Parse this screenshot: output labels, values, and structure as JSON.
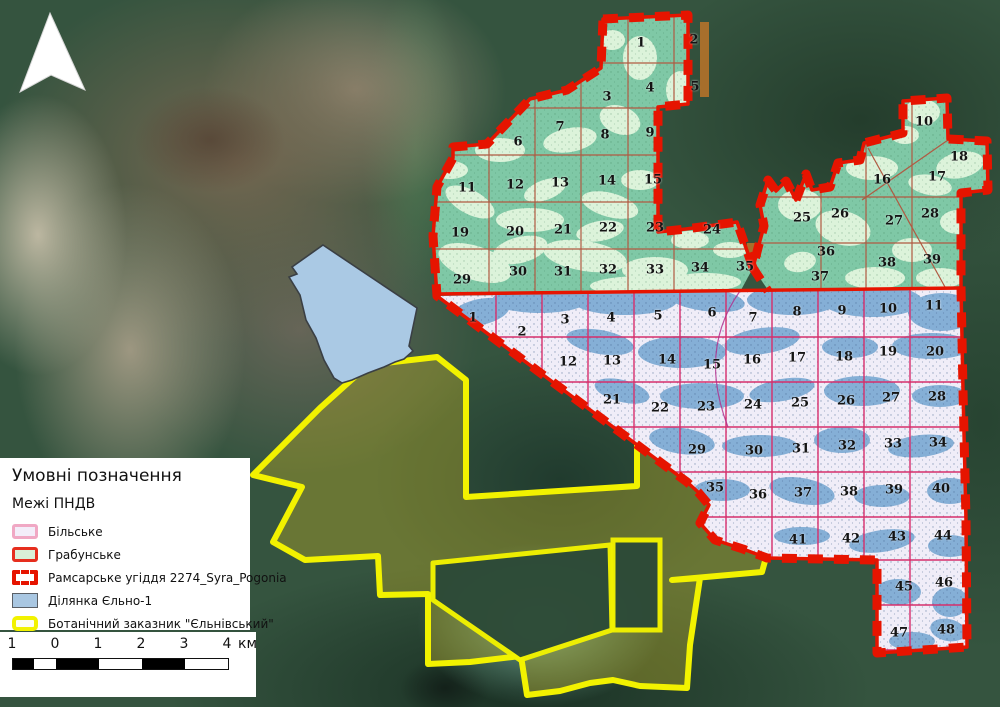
{
  "legend": {
    "title": "Умовні позначення",
    "subtitle": "Межі ПНДВ",
    "items": [
      {
        "type": "bilske",
        "label": "Більське"
      },
      {
        "type": "hrabunske",
        "label": "Грабунське"
      },
      {
        "type": "ramsar",
        "label": "Рамсарське угіддя 2274_Syra_Pogonia"
      },
      {
        "type": "yelno",
        "label": "Ділянка Єльно-1"
      },
      {
        "type": "botanical",
        "label": "Ботанічний заказник \"Єльнівський\""
      }
    ]
  },
  "scalebar": {
    "labels": [
      "1",
      "0",
      "1",
      "2",
      "3",
      "4"
    ],
    "unit": "км"
  },
  "colors": {
    "ramsar_red": "#e61400",
    "grid_green_region": "#b05a42",
    "grid_blue_region": "#d62e6b",
    "hrabunske_base": "#7fc8a6",
    "hrabunske_patch": "#dcf3da",
    "bilske_base": "#f0edf8",
    "yelno_blue": "#85afd6",
    "yelno_polygon_fill": "#aac9e4",
    "botanical_yellow": "#f2f200",
    "north_arrow": "#ffffff"
  },
  "regions": {
    "hrabunske": {
      "name": "Грабунське",
      "compartments": [
        {
          "n": "1",
          "x": 641,
          "y": 43
        },
        {
          "n": "2",
          "x": 694,
          "y": 40
        },
        {
          "n": "3",
          "x": 607,
          "y": 97
        },
        {
          "n": "4",
          "x": 650,
          "y": 88
        },
        {
          "n": "5",
          "x": 695,
          "y": 87
        },
        {
          "n": "6",
          "x": 518,
          "y": 142
        },
        {
          "n": "7",
          "x": 560,
          "y": 127
        },
        {
          "n": "8",
          "x": 605,
          "y": 135
        },
        {
          "n": "9",
          "x": 650,
          "y": 133
        },
        {
          "n": "10",
          "x": 924,
          "y": 122
        },
        {
          "n": "11",
          "x": 467,
          "y": 188
        },
        {
          "n": "12",
          "x": 515,
          "y": 185
        },
        {
          "n": "13",
          "x": 560,
          "y": 183
        },
        {
          "n": "14",
          "x": 607,
          "y": 181
        },
        {
          "n": "15",
          "x": 653,
          "y": 180
        },
        {
          "n": "16",
          "x": 882,
          "y": 180
        },
        {
          "n": "17",
          "x": 937,
          "y": 177
        },
        {
          "n": "18",
          "x": 959,
          "y": 157
        },
        {
          "n": "19",
          "x": 460,
          "y": 233
        },
        {
          "n": "20",
          "x": 515,
          "y": 232
        },
        {
          "n": "21",
          "x": 563,
          "y": 230
        },
        {
          "n": "22",
          "x": 608,
          "y": 228
        },
        {
          "n": "23",
          "x": 655,
          "y": 228
        },
        {
          "n": "24",
          "x": 712,
          "y": 230
        },
        {
          "n": "25",
          "x": 802,
          "y": 218
        },
        {
          "n": "26",
          "x": 840,
          "y": 214
        },
        {
          "n": "27",
          "x": 894,
          "y": 221
        },
        {
          "n": "28",
          "x": 930,
          "y": 214
        },
        {
          "n": "29",
          "x": 462,
          "y": 280
        },
        {
          "n": "30",
          "x": 518,
          "y": 272
        },
        {
          "n": "31",
          "x": 563,
          "y": 272
        },
        {
          "n": "32",
          "x": 608,
          "y": 270
        },
        {
          "n": "33",
          "x": 655,
          "y": 270
        },
        {
          "n": "34",
          "x": 700,
          "y": 268
        },
        {
          "n": "35",
          "x": 745,
          "y": 267
        },
        {
          "n": "36",
          "x": 826,
          "y": 252
        },
        {
          "n": "37",
          "x": 820,
          "y": 277
        },
        {
          "n": "38",
          "x": 887,
          "y": 263
        },
        {
          "n": "39",
          "x": 932,
          "y": 260
        }
      ]
    },
    "bilske": {
      "name": "Більське",
      "compartments": [
        {
          "n": "1",
          "x": 473,
          "y": 318
        },
        {
          "n": "2",
          "x": 522,
          "y": 332
        },
        {
          "n": "3",
          "x": 565,
          "y": 320
        },
        {
          "n": "4",
          "x": 611,
          "y": 318
        },
        {
          "n": "5",
          "x": 658,
          "y": 316
        },
        {
          "n": "6",
          "x": 712,
          "y": 313
        },
        {
          "n": "7",
          "x": 753,
          "y": 318
        },
        {
          "n": "8",
          "x": 797,
          "y": 312
        },
        {
          "n": "9",
          "x": 842,
          "y": 311
        },
        {
          "n": "10",
          "x": 888,
          "y": 309
        },
        {
          "n": "11",
          "x": 934,
          "y": 306
        },
        {
          "n": "12",
          "x": 568,
          "y": 362
        },
        {
          "n": "13",
          "x": 612,
          "y": 361
        },
        {
          "n": "14",
          "x": 667,
          "y": 360
        },
        {
          "n": "15",
          "x": 712,
          "y": 365
        },
        {
          "n": "16",
          "x": 752,
          "y": 360
        },
        {
          "n": "17",
          "x": 797,
          "y": 358
        },
        {
          "n": "18",
          "x": 844,
          "y": 357
        },
        {
          "n": "19",
          "x": 888,
          "y": 352
        },
        {
          "n": "20",
          "x": 935,
          "y": 352
        },
        {
          "n": "21",
          "x": 612,
          "y": 400
        },
        {
          "n": "22",
          "x": 660,
          "y": 408
        },
        {
          "n": "23",
          "x": 706,
          "y": 407
        },
        {
          "n": "24",
          "x": 753,
          "y": 405
        },
        {
          "n": "25",
          "x": 800,
          "y": 403
        },
        {
          "n": "26",
          "x": 846,
          "y": 401
        },
        {
          "n": "27",
          "x": 891,
          "y": 398
        },
        {
          "n": "28",
          "x": 937,
          "y": 397
        },
        {
          "n": "29",
          "x": 697,
          "y": 450
        },
        {
          "n": "30",
          "x": 754,
          "y": 451
        },
        {
          "n": "31",
          "x": 801,
          "y": 449
        },
        {
          "n": "32",
          "x": 847,
          "y": 446
        },
        {
          "n": "33",
          "x": 893,
          "y": 444
        },
        {
          "n": "34",
          "x": 938,
          "y": 443
        },
        {
          "n": "35",
          "x": 715,
          "y": 488
        },
        {
          "n": "36",
          "x": 758,
          "y": 495
        },
        {
          "n": "37",
          "x": 803,
          "y": 493
        },
        {
          "n": "38",
          "x": 849,
          "y": 492
        },
        {
          "n": "39",
          "x": 894,
          "y": 490
        },
        {
          "n": "40",
          "x": 941,
          "y": 489
        },
        {
          "n": "41",
          "x": 798,
          "y": 540
        },
        {
          "n": "42",
          "x": 851,
          "y": 539
        },
        {
          "n": "43",
          "x": 897,
          "y": 537
        },
        {
          "n": "44",
          "x": 943,
          "y": 536
        },
        {
          "n": "45",
          "x": 904,
          "y": 587
        },
        {
          "n": "46",
          "x": 944,
          "y": 583
        },
        {
          "n": "47",
          "x": 899,
          "y": 633
        },
        {
          "n": "48",
          "x": 946,
          "y": 630
        }
      ]
    }
  }
}
